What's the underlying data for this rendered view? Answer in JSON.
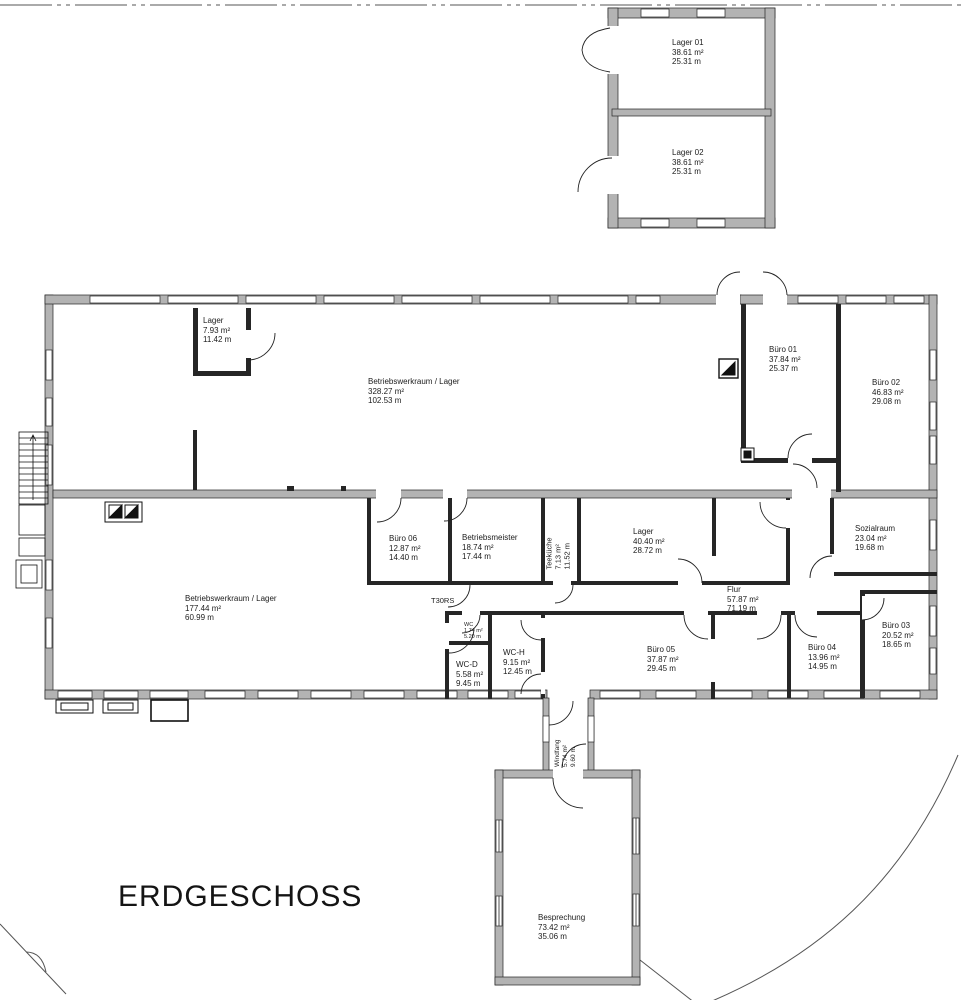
{
  "title": "ERDGESCHOSS",
  "annotations": {
    "fire_door": "T30RS"
  },
  "colors": {
    "wall_fill": "#b3b3b3",
    "wall_dark": "#262626",
    "line": "#222222",
    "text": "#1c1c1c"
  },
  "rooms": {
    "lager01": {
      "name": "Lager 01",
      "area": "38.61 m²",
      "perimeter": "25.31 m"
    },
    "lager02": {
      "name": "Lager 02",
      "area": "38.61 m²",
      "perimeter": "25.31 m"
    },
    "lager_klein": {
      "name": "Lager",
      "area": "7.93 m²",
      "perimeter": "11.42 m"
    },
    "werkraum_ober": {
      "name": "Betriebswerkraum / Lager",
      "area": "328.27 m²",
      "perimeter": "102.53 m"
    },
    "buero01": {
      "name": "Büro 01",
      "area": "37.84 m²",
      "perimeter": "25.37 m"
    },
    "buero02": {
      "name": "Büro 02",
      "area": "46.83 m²",
      "perimeter": "29.08 m"
    },
    "buero06": {
      "name": "Büro 06",
      "area": "12.87 m²",
      "perimeter": "14.40 m"
    },
    "betriebsmeister": {
      "name": "Betriebsmeister",
      "area": "18.74 m²",
      "perimeter": "17.44 m"
    },
    "teekueche": {
      "name": "Teeküche",
      "area": "7.13 m²",
      "perimeter": "11.52 m"
    },
    "lager_mitte": {
      "name": "Lager",
      "area": "40.40 m²",
      "perimeter": "28.72 m"
    },
    "sozialraum": {
      "name": "Sozialraum",
      "area": "23.04 m²",
      "perimeter": "19.68 m"
    },
    "werkraum_unter": {
      "name": "Betriebswerkraum / Lager",
      "area": "177.44 m²",
      "perimeter": "60.99 m"
    },
    "flur": {
      "name": "Flur",
      "area": "57.87 m²",
      "perimeter": "71.19 m"
    },
    "wc": {
      "name": "WC",
      "area": "1.74 m²",
      "perimeter": "5.20 m"
    },
    "wc_d": {
      "name": "WC-D",
      "area": "5.58 m²",
      "perimeter": "9.45 m"
    },
    "wc_h": {
      "name": "WC-H",
      "area": "9.15 m²",
      "perimeter": "12.45 m"
    },
    "buero05": {
      "name": "Büro 05",
      "area": "37.87 m²",
      "perimeter": "29.45 m"
    },
    "buero04": {
      "name": "Büro 04",
      "area": "13.96 m²",
      "perimeter": "14.95 m"
    },
    "buero03": {
      "name": "Büro 03",
      "area": "20.52 m²",
      "perimeter": "18.65 m"
    },
    "windfang": {
      "name": "Windfang",
      "area": "5.74 m²",
      "perimeter": "9.60 m"
    },
    "besprechung": {
      "name": "Besprechung",
      "area": "73.42 m²",
      "perimeter": "35.06 m"
    }
  }
}
